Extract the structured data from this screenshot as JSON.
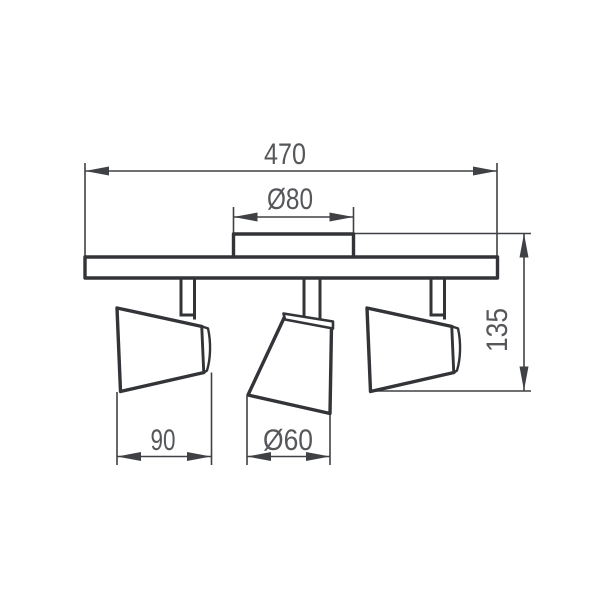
{
  "drawing": {
    "labels": {
      "overall_width": "470",
      "canopy_diameter": "Ø80",
      "overall_height": "135",
      "head_length": "90",
      "head_diameter": "Ø60"
    },
    "colors": {
      "outline": "#323437",
      "dimension": "#3f4144",
      "label": "#55575b",
      "fill": "#ffffff",
      "background": "#ffffff"
    }
  }
}
